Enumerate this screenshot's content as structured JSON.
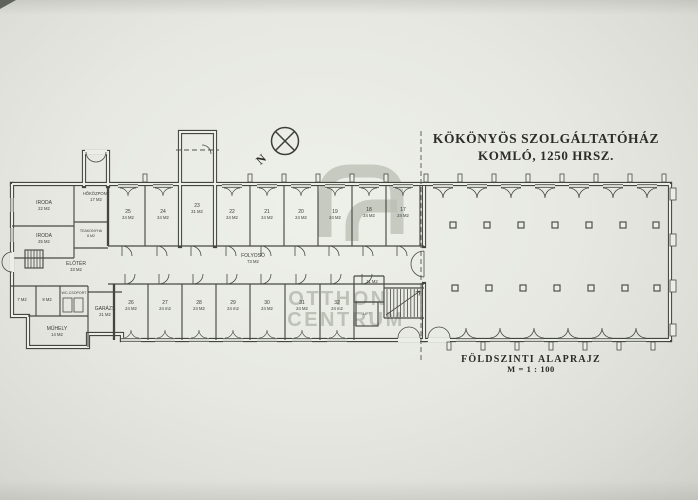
{
  "header": {
    "title_line1": "KÖKÖNYÖS SZOLGÁLTATÓHÁZ",
    "title_line2": "KOMLÓ,  1250 HRSZ."
  },
  "footer": {
    "caption": "FÖLDSZINTI ALAPRAJZ",
    "scale": "M = 1 : 100"
  },
  "north": {
    "label": "N"
  },
  "watermark": {
    "line1": "OTTHON",
    "line2": "CENTRUM",
    "color": "#b9bdb3"
  },
  "corridor": {
    "name": "FOLYOSÓ",
    "area": "73 M2"
  },
  "annex_rooms": [
    {
      "name": "IRODA",
      "area": "22 M2"
    },
    {
      "name": "IRODA",
      "area": "25 M2"
    },
    {
      "name": "HŐKÖZPONT",
      "area": "17 M2"
    },
    {
      "name": "TEAKONYHA",
      "area": "8 M2"
    },
    {
      "name": "ELŐTÉR",
      "area": "33 M2"
    },
    {
      "name": "",
      "area": "7 M2"
    },
    {
      "name": "",
      "area": "8 M2"
    },
    {
      "name": "WC-CSOPORT",
      "area": ""
    },
    {
      "name": "GARÁZS",
      "area": "21 M2"
    },
    {
      "name": "MŰHELY",
      "area": "14 M2"
    }
  ],
  "top_rooms": [
    {
      "number": "25",
      "area": "24 M2"
    },
    {
      "number": "24",
      "area": "24 M2"
    },
    {
      "number": "23",
      "area": "31 M2"
    },
    {
      "number": "22",
      "area": "24 M2"
    },
    {
      "number": "21",
      "area": "24 M2"
    },
    {
      "number": "20",
      "area": "24 M2"
    },
    {
      "number": "19",
      "area": "24 M2"
    },
    {
      "number": "18",
      "area": "24 M2"
    },
    {
      "number": "17",
      "area": "24 M2"
    }
  ],
  "bottom_rooms": [
    {
      "number": "26",
      "area": "24 M2"
    },
    {
      "number": "27",
      "area": "24 m2"
    },
    {
      "number": "28",
      "area": "24 M2"
    },
    {
      "number": "29",
      "area": "24 m2"
    },
    {
      "number": "30",
      "area": "24 M2"
    },
    {
      "number": "31",
      "area": "24 M2"
    },
    {
      "number": "32",
      "area": "24 m2"
    }
  ],
  "service": {
    "lift": "LIFT",
    "small_room_area": "11 M2"
  }
}
